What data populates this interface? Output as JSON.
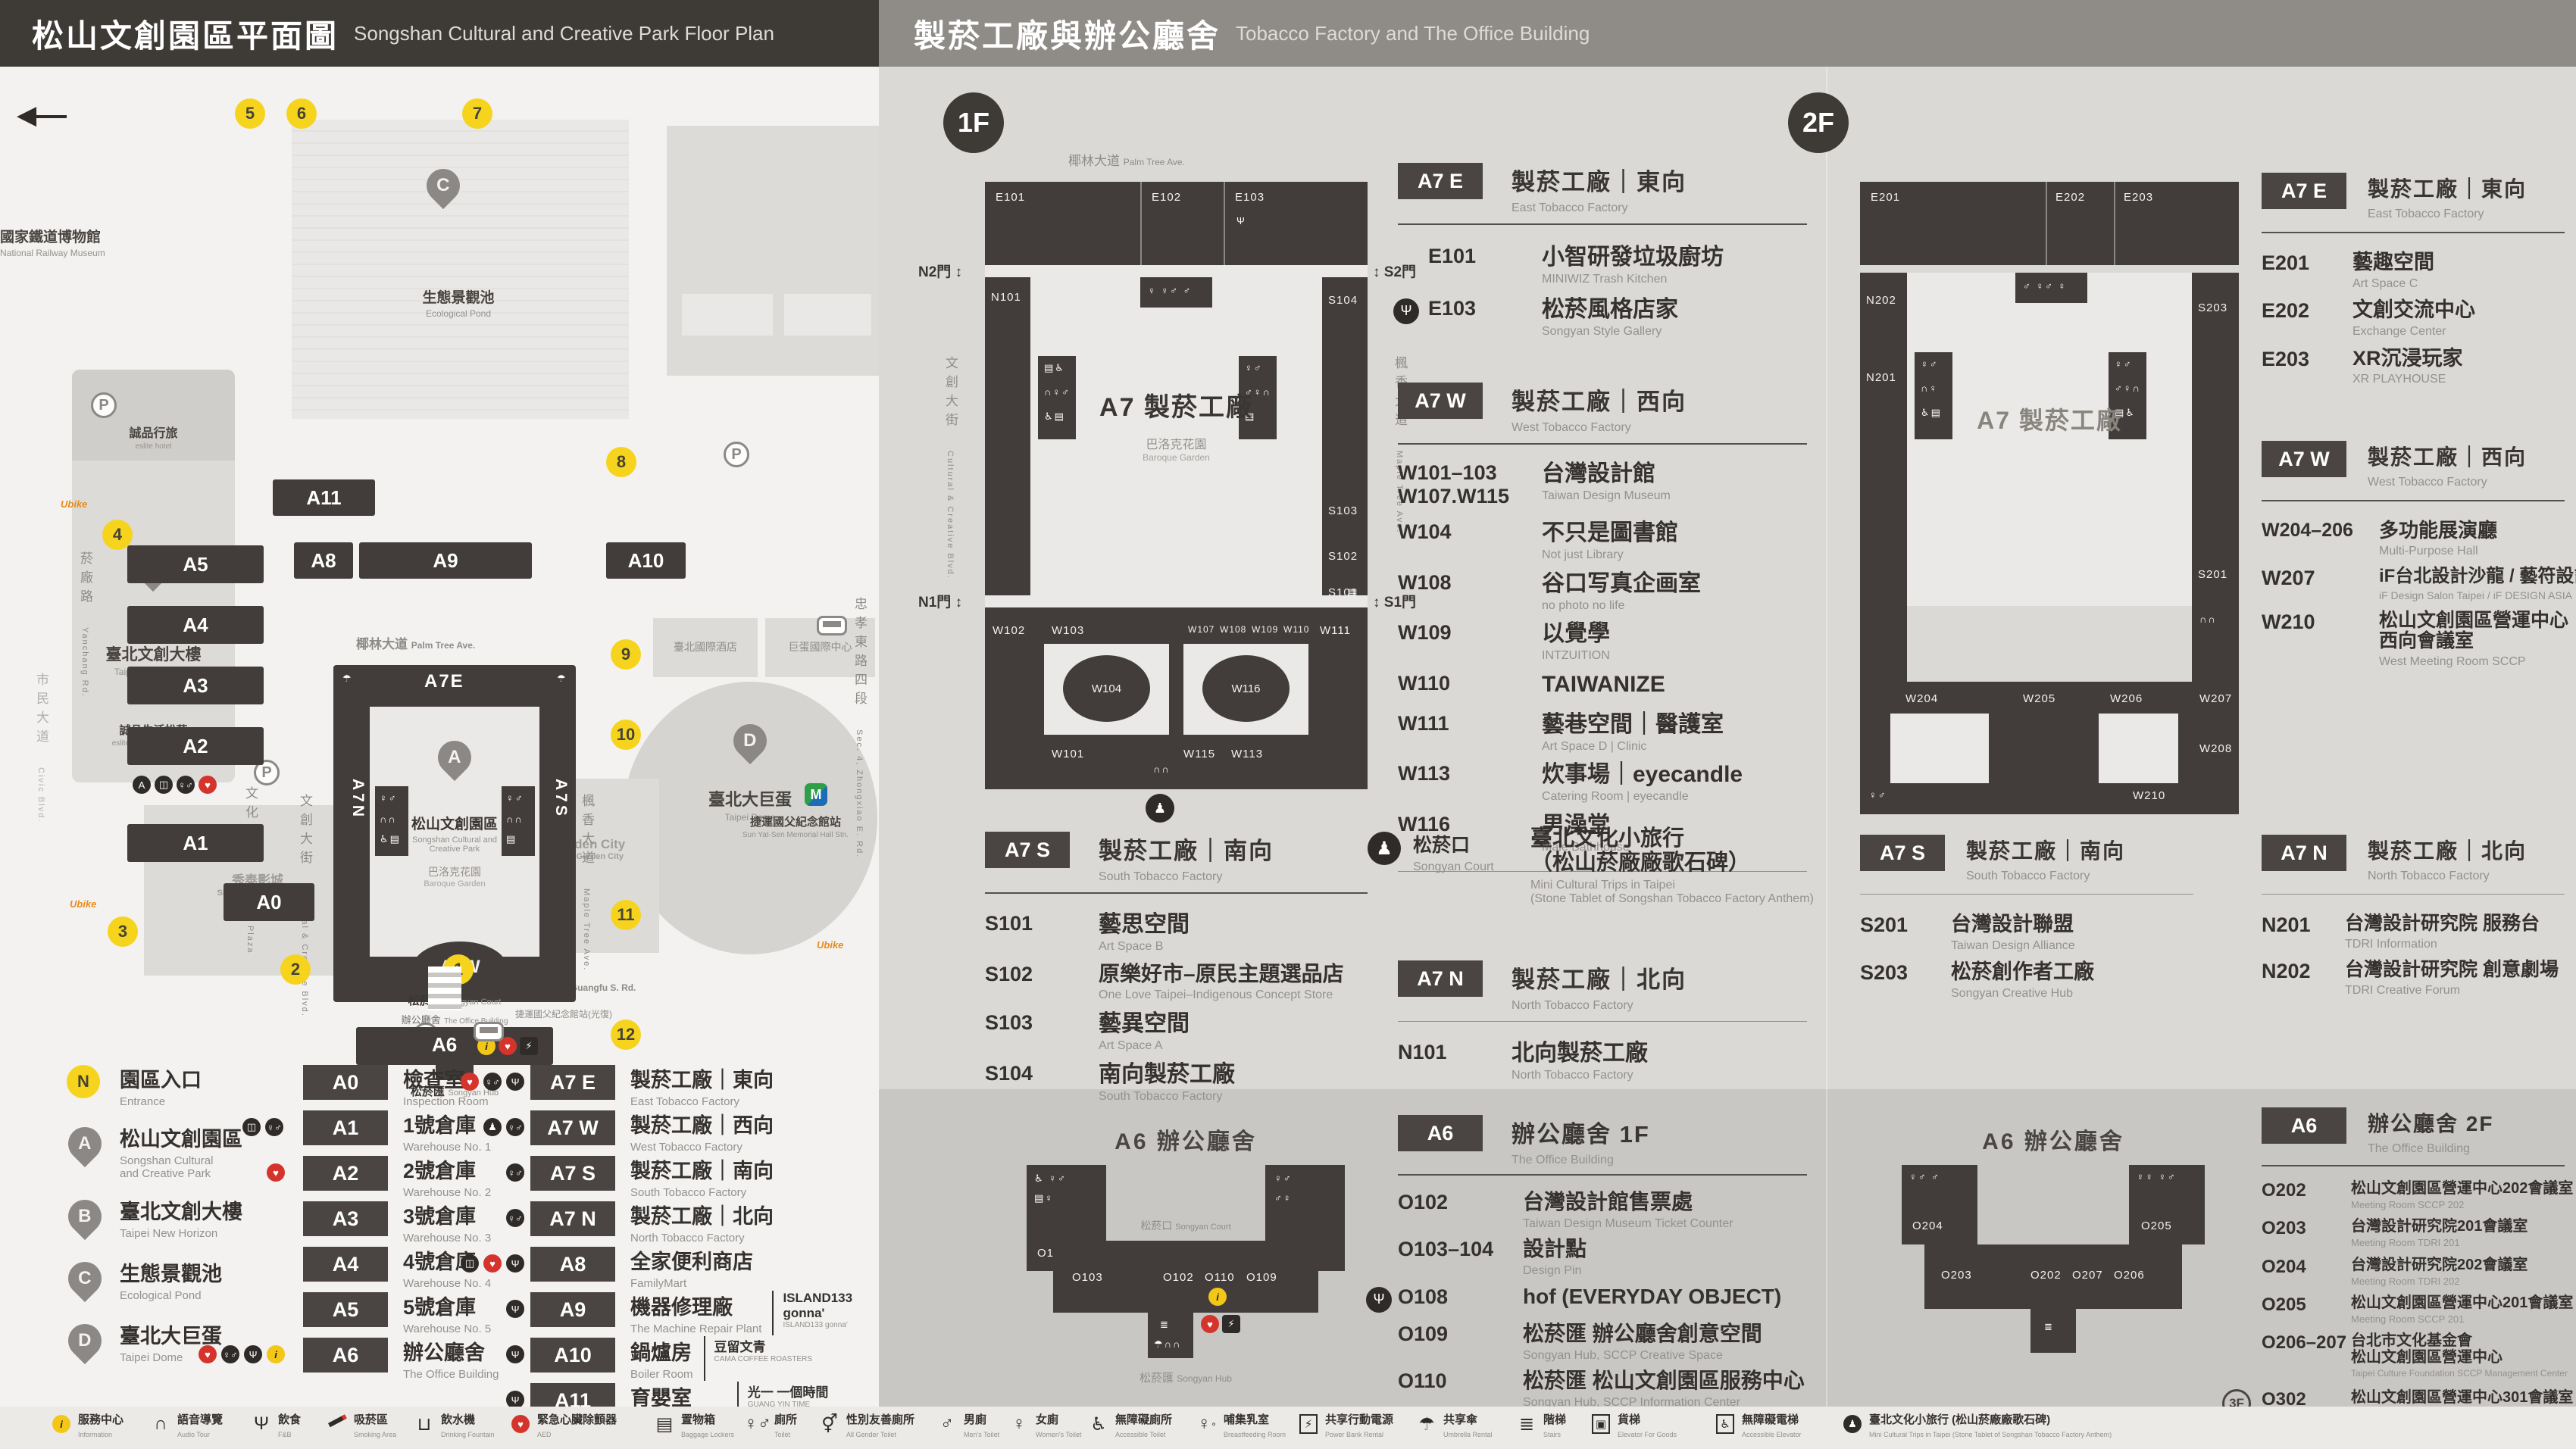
{
  "header": {
    "left_title": "松山文創園區平面圖",
    "left_sub": "Songshan Cultural and Creative Park Floor Plan",
    "right_title": "製菸工廠與辦公廳舍",
    "right_sub": "Tobacco Factory and The Office Building"
  },
  "floors": {
    "f1": "1F",
    "f2": "2F",
    "f3": "3F"
  },
  "map": {
    "railway_cjk": "國家鐵道博物館",
    "railway_en": "National Railway Museum",
    "pond_cjk": "生態景觀池",
    "pond_en": "Ecological Pond",
    "eslite_hotel_cjk": "誠品行旅",
    "eslite_hotel_en": "eslite hotel",
    "new_horizon_cjk": "臺北文創大樓",
    "new_horizon_en": "Taipei New Horizon",
    "eslite_spectrum_cjk": "誠品生活松菸",
    "eslite_spectrum_en": "eslite spectrum Songyan",
    "cultural_plaza_cjk": "文化廣場",
    "cultural_plaza_en": "Cultural Plaza",
    "park_cjk": "松山文創園區",
    "park_en1": "Songshan Cultural and",
    "park_en2": "Creative Park",
    "baroque_cjk": "巴洛克花園",
    "baroque_en": "Baroque Garden",
    "court_cjk": "松菸口",
    "court_en": "Songyan Court",
    "office_cjk": "辦公廳舍",
    "office_en": "The Office Building",
    "hub_cjk": "松菸匯",
    "hub_en": "Songyan Hub",
    "dome_cjk": "臺北大巨蛋",
    "dome_en": "Taipei Dome",
    "garden_city": "遠東Garden City",
    "garden_city_en": "Far Eastern Garden City",
    "cinema_cjk": "秀泰影城",
    "cinema_en": "Showtimes Cinemas",
    "hotel_cjk": "臺北國際酒店",
    "dome_center_cjk": "巨蛋國際中心",
    "mrt_cjk": "捷運國父紀念館站",
    "mrt_en": "Sun Yat-Sen Memorial Hall Stn.",
    "bus_stop_cjk": "捷運國父紀念館站(光復)",
    "st_palm_cjk": "椰林大道",
    "st_palm_en": "Palm Tree Ave.",
    "st_cc_cjk": "文創大街",
    "st_cc_en": "Cultural & Creative Blvd.",
    "st_maple_cjk": "楓香大道",
    "st_maple_en": "Maple Tree Ave.",
    "st_songyan_cjk": "松菸大道",
    "st_songyan_en": "Songyan Ave.",
    "st_yanchang_cjk": "菸廠路",
    "st_yanchang_en": "Yanchang Rd.",
    "st_guangfu_cjk": "光復南路",
    "st_guangfu_en": "Guangfu S. Rd.",
    "st_zhongxiao_cjk": "忠孝東路四段",
    "st_zhongxiao_en": "Sec. 4, Zhongxiao E. Rd.",
    "st_civic_cjk": "市民大道",
    "st_civic_en": "Civic Blvd.",
    "a0": "A0",
    "a1": "A1",
    "a2": "A2",
    "a3": "A3",
    "a4": "A4",
    "a5": "A5",
    "a6": "A6",
    "a7e": "A7E",
    "a7w": "A7W",
    "a7n": "A7N",
    "a7s": "A7S",
    "a8": "A8",
    "a9": "A9",
    "a10": "A10",
    "a11": "A11",
    "ubike": "Ubike",
    "nums": [
      "1",
      "2",
      "3",
      "4",
      "5",
      "6",
      "7",
      "8",
      "9",
      "10",
      "11",
      "12"
    ]
  },
  "legend": {
    "entrance_badge": "N",
    "entrance_cjk": "園區入口",
    "entrance_en": "Entrance",
    "pins": [
      {
        "letter": "A",
        "cjk": "松山文創園區",
        "en1": "Songshan Cultural",
        "en2": "and Creative Park"
      },
      {
        "letter": "B",
        "cjk": "臺北文創大樓",
        "en1": "Taipei New Horizon",
        "en2": ""
      },
      {
        "letter": "C",
        "cjk": "生態景觀池",
        "en1": "Ecological Pond",
        "en2": ""
      },
      {
        "letter": "D",
        "cjk": "臺北大巨蛋",
        "en1": "Taipei Dome",
        "en2": ""
      }
    ],
    "col2": [
      {
        "code": "A0",
        "cjk": "檢查室",
        "en": "Inspection Room"
      },
      {
        "code": "A1",
        "cjk": "1號倉庫",
        "en": "Warehouse No. 1"
      },
      {
        "code": "A2",
        "cjk": "2號倉庫",
        "en": "Warehouse No. 2"
      },
      {
        "code": "A3",
        "cjk": "3號倉庫",
        "en": "Warehouse No. 3"
      },
      {
        "code": "A4",
        "cjk": "4號倉庫",
        "en": "Warehouse No. 4"
      },
      {
        "code": "A5",
        "cjk": "5號倉庫",
        "en": "Warehouse No. 5"
      },
      {
        "code": "A6",
        "cjk": "辦公廳舍",
        "en": "The Office Building"
      }
    ],
    "col3": [
      {
        "code": "A7 E",
        "cjk": "製菸工廠｜東向",
        "en": "East Tobacco Factory"
      },
      {
        "code": "A7 W",
        "cjk": "製菸工廠｜西向",
        "en": "West Tobacco Factory"
      },
      {
        "code": "A7 S",
        "cjk": "製菸工廠｜南向",
        "en": "South Tobacco Factory"
      },
      {
        "code": "A7 N",
        "cjk": "製菸工廠｜北向",
        "en": "North Tobacco Factory"
      },
      {
        "code": "A8",
        "cjk": "全家便利商店",
        "en": "FamilyMart"
      },
      {
        "code": "A9",
        "cjk": "機器修理廠",
        "brand": "ISLAND133 gonna'",
        "brand_sub": "ISLAND133 gonna'",
        "en": "The Machine Repair Plant"
      },
      {
        "code": "A10",
        "cjk": "鍋爐房",
        "brand": "豆留文青",
        "brand_sub": "CAMA COFFEE ROASTERS",
        "en": "Boiler Room"
      },
      {
        "code": "A11",
        "cjk": "育嬰室",
        "brand": "光一 一個時間",
        "brand_sub": "GUANG YIN TIME",
        "en": "The Nursery Room"
      }
    ]
  },
  "strip": [
    {
      "cjk": "服務中心",
      "en": "Information"
    },
    {
      "cjk": "語音導覽",
      "en": "Audio Tour"
    },
    {
      "cjk": "飲食",
      "en": "F&B"
    },
    {
      "cjk": "吸菸區",
      "en": "Smoking Area"
    },
    {
      "cjk": "飲水機",
      "en": "Drinking Fountain"
    },
    {
      "cjk": "緊急心臟除顫器",
      "en": "AED"
    },
    {
      "cjk": "置物箱",
      "en": "Baggage Lockers"
    },
    {
      "cjk": "廁所",
      "en": "Toilet"
    },
    {
      "cjk": "性別友善廁所",
      "en": "All Gender Toilet"
    },
    {
      "cjk": "男廁",
      "en": "Men's Toilet"
    },
    {
      "cjk": "女廁",
      "en": "Women's Toilet"
    },
    {
      "cjk": "無障礙廁所",
      "en": "Accessible Toilet"
    },
    {
      "cjk": "哺集乳室",
      "en": "Breastfeeding Room"
    },
    {
      "cjk": "共享行動電源",
      "en": "Power Bank Rental"
    },
    {
      "cjk": "共享傘",
      "en": "Umbrella Rental"
    },
    {
      "cjk": "階梯",
      "en": "Stairs"
    },
    {
      "cjk": "貨梯",
      "en": "Elevator For Goods"
    },
    {
      "cjk": "無障礙電梯",
      "en": "Accessible Elevator"
    },
    {
      "cjk": "臺北文化小旅行 (松山菸廠廠歌石碑)",
      "en": "Mini Cultural Trips in Taipei (Stone Tablet of Songshan Tobacco Factory Anthem)"
    }
  ],
  "onef": {
    "a7e": {
      "badge": "A7 E",
      "title": "製菸工廠｜東向",
      "en": "East Tobacco Factory",
      "rows": [
        {
          "code": "E101",
          "cjk": "小智研發垃圾廚坊",
          "en": "MINIWIZ Trash Kitchen"
        },
        {
          "code": "E103",
          "cjk": "松菸風格店家",
          "en": "Songyan Style Gallery"
        }
      ]
    },
    "a7w": {
      "badge": "A7 W",
      "title": "製菸工廠｜西向",
      "en": "West Tobacco Factory",
      "rows": [
        {
          "code": "W101–103",
          "code2": "W107.W115",
          "cjk": "台灣設計館",
          "en": "Taiwan Design Museum"
        },
        {
          "code": "W104",
          "cjk": "不只是圖書館",
          "en": "Not just Library"
        },
        {
          "code": "W108",
          "cjk": "谷口写真企画室",
          "en": "no photo no life"
        },
        {
          "code": "W109",
          "cjk": "以覺學",
          "en": "INTZUITION"
        },
        {
          "code": "W110",
          "cjk": "TAIWANIZE",
          "en": ""
        },
        {
          "code": "W111",
          "cjk": "藝巷空間｜醫護室",
          "en": "Art Space D | Clinic"
        },
        {
          "code": "W113",
          "cjk": "炊事場｜eyecandle",
          "en": "Catering Room | eyecandle"
        },
        {
          "code": "W116",
          "cjk": "男澡堂",
          "en": "Male Bathhouse"
        }
      ]
    },
    "a7s": {
      "badge": "A7 S",
      "title": "製菸工廠｜南向",
      "en": "South Tobacco Factory",
      "rows": [
        {
          "code": "S101",
          "cjk": "藝思空間",
          "en": "Art Space B"
        },
        {
          "code": "S102",
          "cjk": "原樂好市–原民主題選品店",
          "en": "One Love Taipei–Indigenous Concept Store"
        },
        {
          "code": "S103",
          "cjk": "藝異空間",
          "en": "Art Space A"
        },
        {
          "code": "S104",
          "cjk": "南向製菸工廠",
          "en": "South Tobacco Factory"
        }
      ]
    },
    "court": {
      "cjk": "松菸口",
      "en": "Songyan Court",
      "line1": "臺北文化小旅行",
      "line2": "（松山菸廠廠歌石碑）",
      "en1": "Mini Cultural Trips in Taipei",
      "en2": "(Stone Tablet of Songshan Tobacco Factory Anthem)"
    },
    "a7n": {
      "badge": "A7 N",
      "title": "製菸工廠｜北向",
      "en": "North Tobacco Factory",
      "rows": [
        {
          "code": "N101",
          "cjk": "北向製菸工廠",
          "en": "North Tobacco Factory"
        }
      ]
    },
    "a6": {
      "badge": "A6",
      "title": "辦公廳舍 1F",
      "en": "The Office Building",
      "rows": [
        {
          "code": "O102",
          "cjk": "台灣設計館售票處",
          "en": "Taiwan Design Museum Ticket Counter"
        },
        {
          "code": "O103–104",
          "cjk": "設計點",
          "en": "Design Pin"
        },
        {
          "code": "O108",
          "cjk": "hof (EVERYDAY OBJECT)",
          "en": ""
        },
        {
          "code": "O109",
          "cjk": "松菸匯 辦公廳舍創意空間",
          "en": "Songyan Hub, SCCP Creative Space"
        },
        {
          "code": "O110",
          "cjk": "松菸匯 松山文創園區服務中心",
          "en": "Songyan Hub, SCCP Information Center"
        }
      ]
    }
  },
  "twof": {
    "a7e": {
      "badge": "A7 E",
      "title": "製菸工廠｜東向",
      "en": "East Tobacco Factory",
      "rows": [
        {
          "code": "E201",
          "cjk": "藝趣空間",
          "en": "Art Space C"
        },
        {
          "code": "E202",
          "cjk": "文創交流中心",
          "en": "Exchange Center"
        },
        {
          "code": "E203",
          "cjk": "XR沉浸玩家",
          "en": "XR PLAYHOUSE"
        }
      ]
    },
    "a7w": {
      "badge": "A7 W",
      "title": "製菸工廠｜西向",
      "en": "West Tobacco Factory",
      "rows": [
        {
          "code": "W204–206",
          "cjk": "多功能展演廳",
          "en": "Multi-Purpose Hall"
        },
        {
          "code": "W207",
          "cjk": "iF台北設計沙龍 / 藝符設計",
          "en": "iF Design Salon Taipei / iF DESIGN ASIA"
        },
        {
          "code": "W210",
          "cjk": "松山文創園區營運中心",
          "cjk2": "西向會議室",
          "en": "West Meeting Room SCCP"
        }
      ]
    },
    "a7s": {
      "badge": "A7 S",
      "title": "製菸工廠｜南向",
      "en": "South Tobacco Factory",
      "rows": [
        {
          "code": "S201",
          "cjk": "台灣設計聯盟",
          "en": "Taiwan Design Alliance"
        },
        {
          "code": "S203",
          "cjk": "松菸創作者工廠",
          "en": "Songyan Creative Hub"
        }
      ]
    },
    "a7n": {
      "badge": "A7 N",
      "title": "製菸工廠｜北向",
      "en": "North Tobacco Factory",
      "rows": [
        {
          "code": "N201",
          "cjk": "台灣設計研究院 服務台",
          "en": "TDRI Information"
        },
        {
          "code": "N202",
          "cjk": "台灣設計研究院 創意劇場",
          "en": "TDRI Creative Forum"
        }
      ]
    },
    "a6": {
      "badge": "A6",
      "title": "辦公廳舍 2F",
      "en": "The Office Building",
      "rows": [
        {
          "code": "O202",
          "cjk": "松山文創園區營運中心202會議室",
          "en": "Meeting Room SCCP 202"
        },
        {
          "code": "O203",
          "cjk": "台灣設計研究院201會議室",
          "en": "Meeting Room TDRI 201"
        },
        {
          "code": "O204",
          "cjk": "台灣設計研究院202會議室",
          "en": "Meeting Room TDRI 202"
        },
        {
          "code": "O205",
          "cjk": "松山文創園區營運中心201會議室",
          "en": "Meeting Room SCCP 201"
        },
        {
          "code": "O206–207",
          "cjk": "台北市文化基金會",
          "cjk2": "松山文創園區營運中心",
          "en": "Taipei Culture Foundation SCCP Management Center"
        },
        {
          "code": "O302",
          "pre": "3F",
          "cjk": "松山文創園區營運中心301會議室",
          "en": "Meeting Room SCCP 301"
        }
      ]
    }
  },
  "plans": {
    "p1f": {
      "center": "A7 製菸工廠",
      "n2": "N2門",
      "s2": "S2門",
      "n1": "N1門",
      "s1": "S1門",
      "e101": "E101",
      "e102": "E102",
      "e103": "E103",
      "n101": "N101",
      "s101": "S101",
      "s102": "S102",
      "s103": "S103",
      "s104": "S104",
      "w101": "W101",
      "w102": "W102",
      "w103": "W103",
      "w104": "W104",
      "w107": "W107",
      "w108": "W108",
      "w109": "W109",
      "w110": "W110",
      "w111": "W111",
      "w113": "W113",
      "w115": "W115",
      "w116": "W116"
    },
    "p2f": {
      "center": "A7 製菸工廠",
      "e201": "E201",
      "e202": "E202",
      "e203": "E203",
      "n201": "N201",
      "n202": "N202",
      "s201": "S201",
      "s203": "S203",
      "w204": "W204",
      "w205": "W205",
      "w206": "W206",
      "w207": "W207",
      "w208": "W208",
      "w210": "W210"
    },
    "a61": {
      "title": "A6 辦公廳舍",
      "o102": "O102",
      "o103": "O103",
      "o104": "O104",
      "o108": "O108",
      "o109": "O109",
      "o110": "O110"
    },
    "a62": {
      "title": "A6 辦公廳舍",
      "o202": "O202",
      "o203": "O203",
      "o204": "O204",
      "o205": "O205",
      "o206": "O206",
      "o207": "O207"
    }
  }
}
